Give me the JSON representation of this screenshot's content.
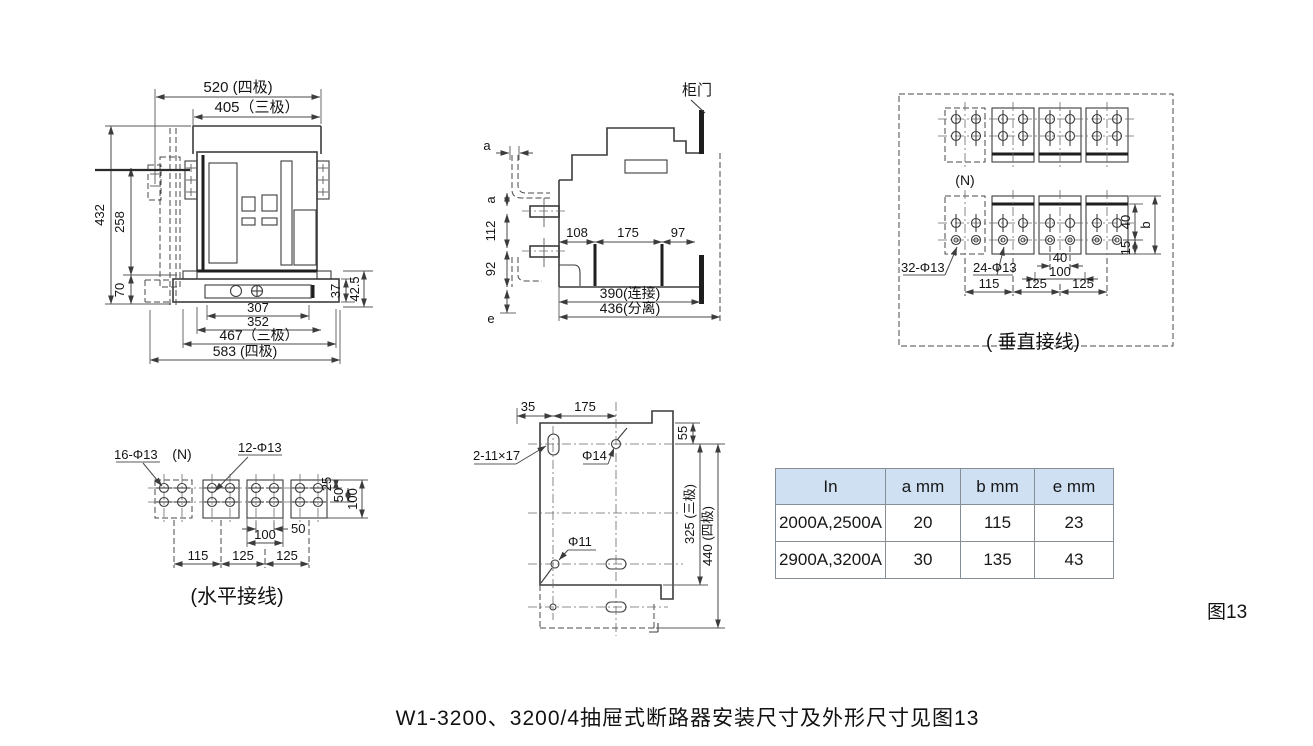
{
  "figure": {
    "label": "图13",
    "caption": "W1-3200、3200/4抽屉式断路器安装尺寸及外形尺寸见图13"
  },
  "front_view": {
    "dim_520": "520 (四极)",
    "dim_405": "405（三极）",
    "dim_432": "432",
    "dim_258": "258",
    "dim_70": "70",
    "dim_37": "37",
    "dim_42_5": "42.5",
    "dim_307": "307",
    "dim_352": "352",
    "dim_467": "467（三极）",
    "dim_583": "583 (四极)"
  },
  "side_view": {
    "door_label": "柜门",
    "dim_a_top": "a",
    "dim_a_side": "a",
    "dim_112": "112",
    "dim_92": "92",
    "dim_e": "e",
    "dim_108": "108",
    "dim_175": "175",
    "dim_97": "97",
    "dim_390": "390(连接)",
    "dim_436": "436(分离)"
  },
  "vertical_wiring": {
    "caption": "( 垂直接线)",
    "label_n": "(N)",
    "label_holes_32": "32-Φ13",
    "label_holes_24": "24-Φ13",
    "dim_40_pitch": "40",
    "dim_100": "100",
    "dim_115": "115",
    "dim_125_a": "125",
    "dim_125_b": "125",
    "dim_40_side": "40",
    "dim_b": "b",
    "dim_15": "15"
  },
  "horizontal_wiring": {
    "caption": "(水平接线)",
    "label_holes_16": "16-Φ13",
    "label_n": "(N)",
    "label_holes_12": "12-Φ13",
    "dim_25": "25",
    "dim_50_side": "50",
    "dim_100_side": "100",
    "dim_50_pitch": "50",
    "dim_100_pitch": "100",
    "dim_115": "115",
    "dim_125_a": "125",
    "dim_125_b": "125"
  },
  "mounting_plate": {
    "dim_35": "35",
    "dim_175": "175",
    "label_slot": "2-11×17",
    "label_hole_14": "Φ14",
    "label_hole_11": "Φ11",
    "dim_55": "55",
    "dim_325": "325 (三极)",
    "dim_440": "440 (四极)"
  },
  "spec_table": {
    "headers": [
      "In",
      "a mm",
      "b mm",
      "e mm"
    ],
    "rows": [
      [
        "2000A,2500A",
        "20",
        "115",
        "23"
      ],
      [
        "2900A,3200A",
        "30",
        "135",
        "43"
      ]
    ],
    "header_bg": "#cfe0f2"
  }
}
